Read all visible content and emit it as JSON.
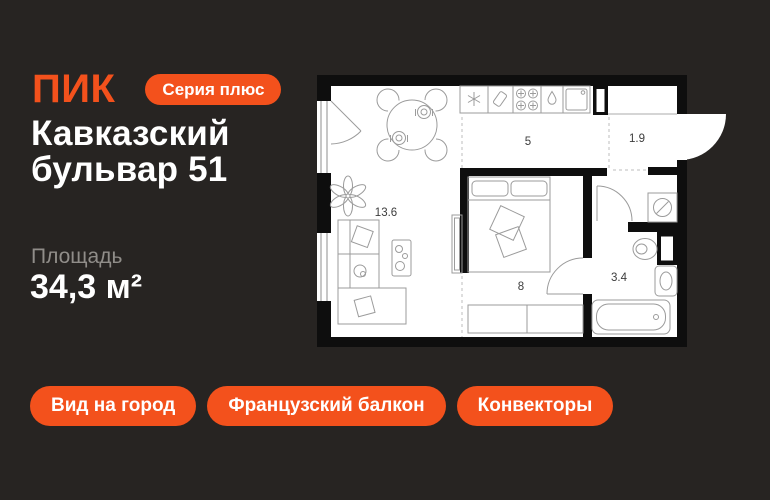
{
  "brand": {
    "logo_text": "ПИК",
    "badge_label": "Серия плюс"
  },
  "listing": {
    "title": "Кавказский бульвар 51",
    "area_label": "Площадь",
    "area_value": "34,3 м²"
  },
  "feature_tags": [
    {
      "label": "Вид на город"
    },
    {
      "label": "Французский балкон"
    },
    {
      "label": "Конвекторы"
    }
  ],
  "floor_plan": {
    "rooms": [
      {
        "name": "living-room",
        "area_label": "13.6"
      },
      {
        "name": "kitchen",
        "area_label": "5"
      },
      {
        "name": "hallway",
        "area_label": "1.9"
      },
      {
        "name": "bedroom",
        "area_label": "8"
      },
      {
        "name": "bathroom",
        "area_label": "3.4"
      }
    ],
    "fixtures": [
      "kitchen-counter",
      "fridge",
      "cutting-board",
      "stove",
      "water-drop",
      "sink",
      "dining-table",
      "chairs",
      "balcony-door",
      "plant",
      "sofa",
      "coffee-table",
      "tv-stand",
      "bed",
      "dresser",
      "entrance-door",
      "bedroom-door",
      "bathroom-door",
      "washing-machine",
      "toilet",
      "washbasin",
      "bathtub"
    ]
  },
  "colors": {
    "background": "#272422",
    "accent": "#F3511C",
    "text_primary": "#FFFFFF",
    "text_secondary": "#908D89",
    "plan_walls": "#0E0E0E",
    "plan_background": "#FFFFFF"
  }
}
